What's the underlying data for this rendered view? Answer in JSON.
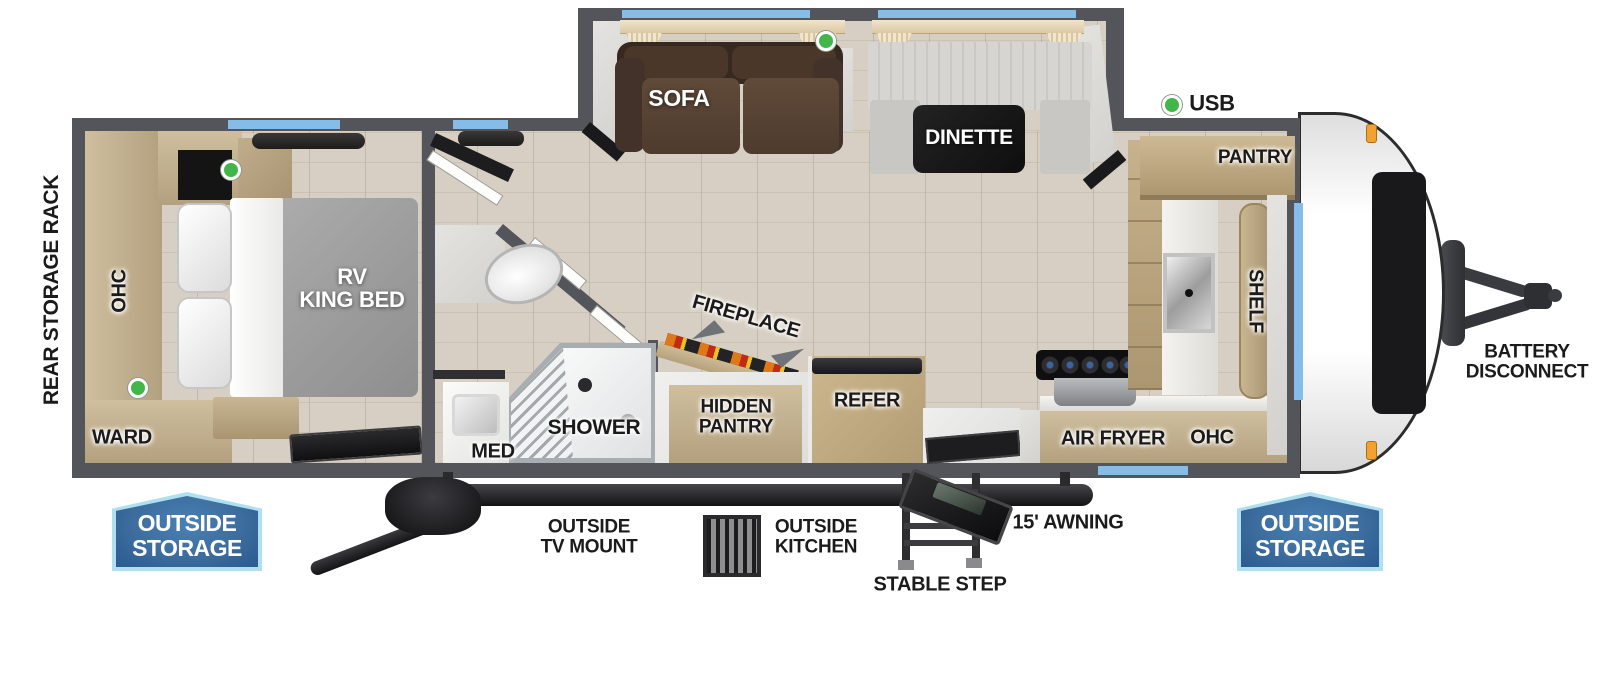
{
  "floorplan": {
    "title": "travel-trailer-floorplan",
    "labels": {
      "rear_storage_rack": "REAR STORAGE RACK",
      "bedroom_ohc": "OHC",
      "ward": "WARD",
      "rv_king_bed": "RV\nKING BED",
      "sofa": "SOFA",
      "dinette": "DINETTE",
      "usb": "USB",
      "pantry": "PANTRY",
      "shelf": "SHELF",
      "med": "MED",
      "shower": "SHOWER",
      "hidden_pantry": "HIDDEN\nPANTRY",
      "fireplace": "FIREPLACE",
      "refer": "REFER",
      "air_fryer": "AIR FRYER",
      "kitchen_ohc": "OHC",
      "battery_disconnect": "BATTERY\nDISCONNECT"
    },
    "callouts": {
      "outside_storage_left": "OUTSIDE\nSTORAGE",
      "outside_tv_mount": "OUTSIDE\nTV MOUNT",
      "outside_kitchen": "OUTSIDE\nKITCHEN",
      "stable_step": "STABLE STEP",
      "awning": "15' AWNING",
      "outside_storage_right": "OUTSIDE\nSTORAGE"
    },
    "legend": {
      "usb_marker_color": "#43b649"
    },
    "colors": {
      "wall": "#54555a",
      "floor_wood": "#d7cfc3",
      "cabinet_tan": "#c3ae8a",
      "window_blue": "#85bce8",
      "badge_border": "#aee0f2",
      "badge_fill": "#3c6d9e",
      "marker_orange": "#f2a233",
      "sofa_brown": "#4e3b2e",
      "mattress_gray": "#9c9c9c"
    }
  }
}
